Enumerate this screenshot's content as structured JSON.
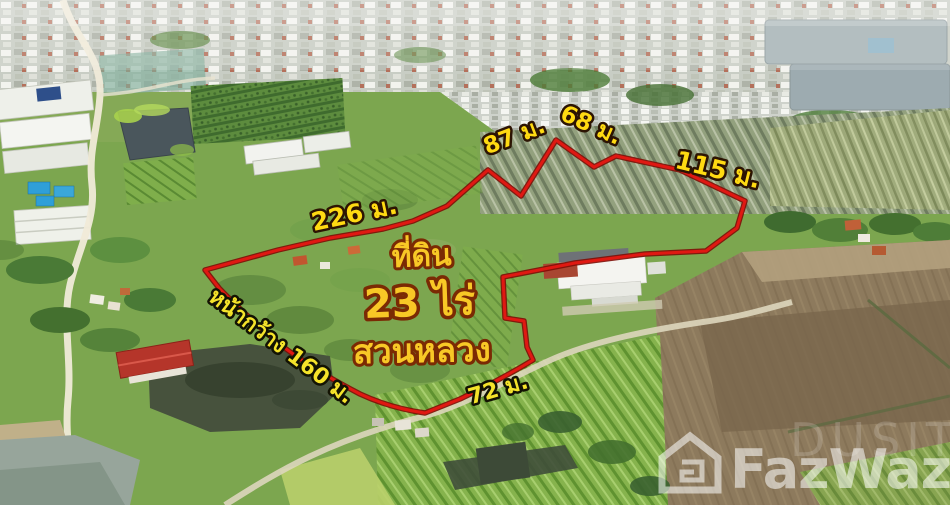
{
  "plot_labels": {
    "title_line1": "ที่ดิน",
    "title_line2": "23 ไร่",
    "title_line3": "สวนหลวง",
    "measurements": {
      "top_left_edge": "226 ม.",
      "top_edge_1": "87 ม.",
      "top_edge_2": "68 ม.",
      "top_right_edge": "115 ม.",
      "frontage_edge": "หน้ากว้าง 160 ม.",
      "bottom_edge": "72 ม."
    }
  },
  "watermark": {
    "brand": "FazWaz",
    "ghost_text": "DUSIT"
  },
  "colors": {
    "boundary_red": "#e01812",
    "boundary_dark_red": "#7e0d06",
    "measure_label_yellow": "#ffd90a",
    "title_label_gold": "#f8c826",
    "watermark_white": "#ffffff"
  }
}
